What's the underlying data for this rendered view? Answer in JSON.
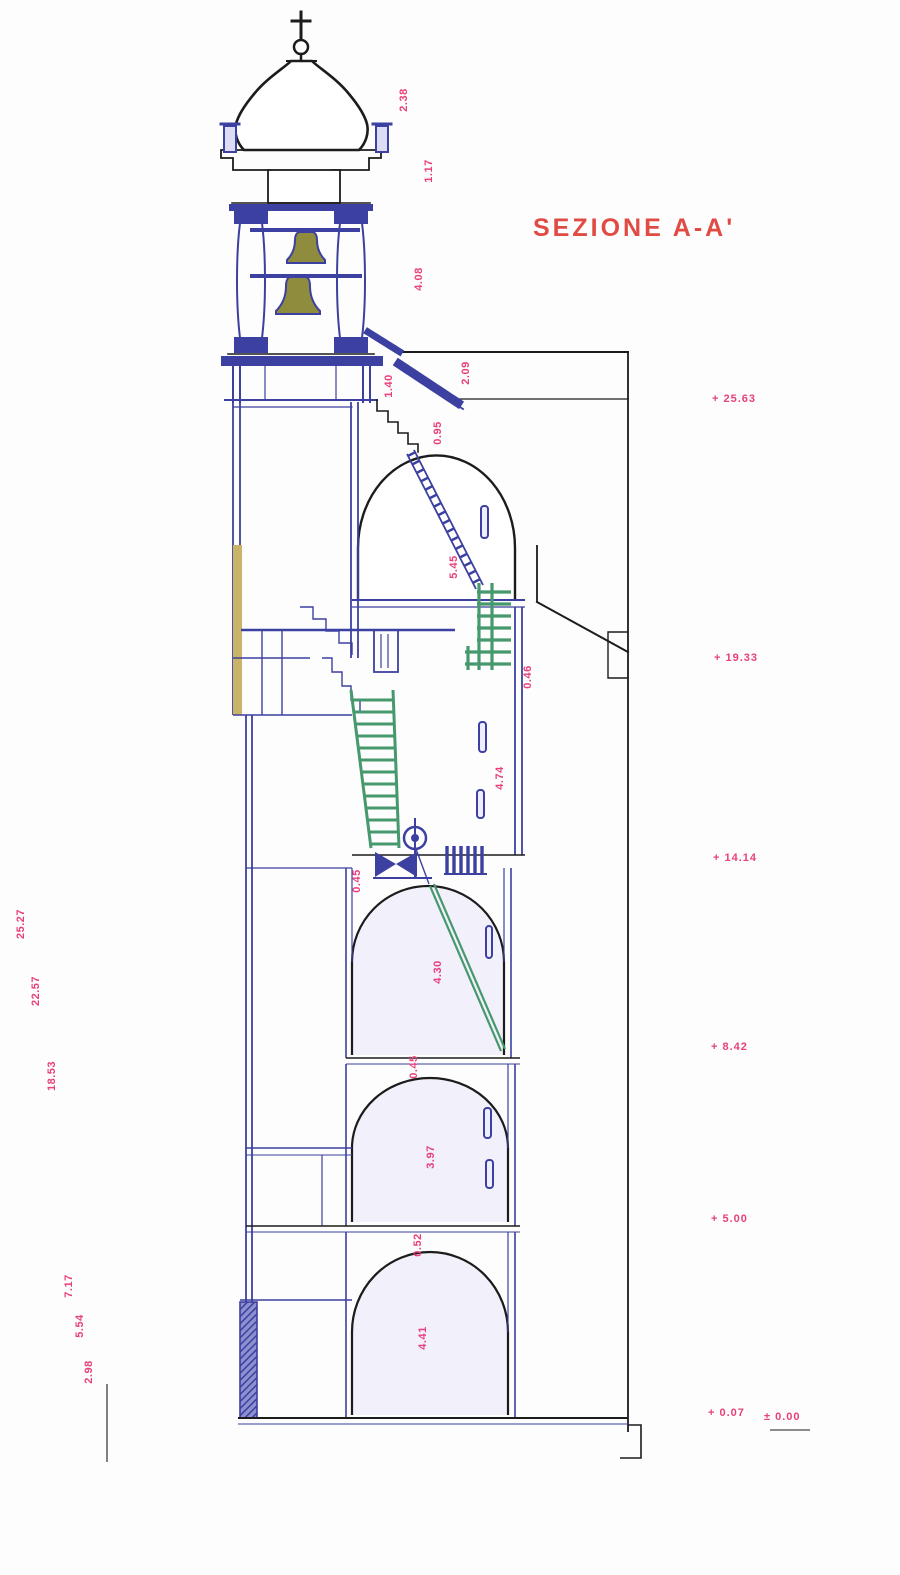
{
  "title": "SEZIONE A-A'",
  "colors": {
    "wall_blue": "#3c40a0",
    "outline_black": "#1c1c1c",
    "stair_green": "#46996d",
    "bell_olive": "#8f8c3e",
    "dimension_magenta": "#e8407a",
    "title_red": "#e04b44",
    "masonry_tan": "#c9b469"
  },
  "elevations": [
    {
      "label": "+ 25.63"
    },
    {
      "label": "+ 19.33"
    },
    {
      "label": "+ 14.14"
    },
    {
      "label": "+ 8.42"
    },
    {
      "label": "+ 5.00"
    },
    {
      "label": "+ 0.07"
    },
    {
      "label": "± 0.00"
    }
  ],
  "left_dims": [
    {
      "label": "25.27"
    },
    {
      "label": "22.57"
    },
    {
      "label": "18.53"
    },
    {
      "label": "7.17"
    },
    {
      "label": "5.54"
    },
    {
      "label": "2.98"
    }
  ],
  "dims": [
    {
      "label": "2.38"
    },
    {
      "label": "1.17"
    },
    {
      "label": "4.08"
    },
    {
      "label": "1.40"
    },
    {
      "label": "2.09"
    },
    {
      "label": "0.95"
    },
    {
      "label": "5.45"
    },
    {
      "label": "0.46"
    },
    {
      "label": "4.74"
    },
    {
      "label": "0.45"
    },
    {
      "label": "4.30"
    },
    {
      "label": "0.45"
    },
    {
      "label": "3.97"
    },
    {
      "label": "0.52"
    },
    {
      "label": "4.41"
    }
  ]
}
